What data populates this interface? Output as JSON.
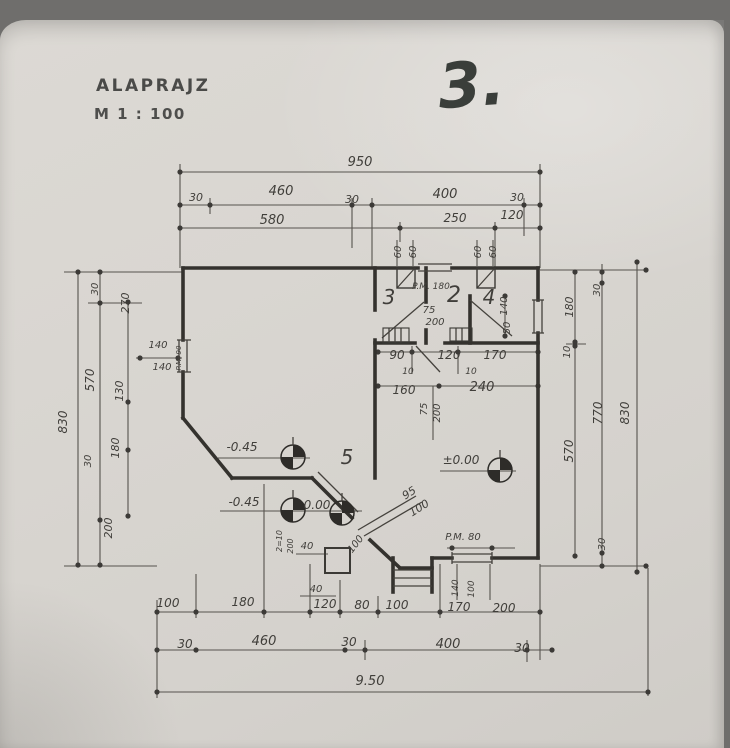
{
  "header": {
    "title": "ALAPRAJZ",
    "scale": "M 1 : 100",
    "page_number": "3."
  },
  "plan": {
    "type": "architectural floor plan",
    "rooms": [
      "1",
      "2",
      "3",
      "4",
      "5"
    ],
    "levels": [
      "-0.45",
      "0.00",
      "±0.00"
    ],
    "overall_width": "950",
    "overall_width_meters": "9.50",
    "overall_height_left": "830",
    "overall_height_right": "830",
    "labels": [
      {
        "t": "950",
        "x": 360,
        "y": 166,
        "s": 13,
        "n": "dim-overall-top"
      },
      {
        "t": "30",
        "x": 196,
        "y": 201,
        "s": 11
      },
      {
        "t": "460",
        "x": 281,
        "y": 195,
        "s": 13
      },
      {
        "t": "30",
        "x": 352,
        "y": 203,
        "s": 11
      },
      {
        "t": "400",
        "x": 445,
        "y": 198,
        "s": 13
      },
      {
        "t": "30",
        "x": 517,
        "y": 201,
        "s": 11
      },
      {
        "t": "580",
        "x": 272,
        "y": 224,
        "s": 13
      },
      {
        "t": "250",
        "x": 455,
        "y": 222,
        "s": 12
      },
      {
        "t": "120",
        "x": 512,
        "y": 219,
        "s": 12
      },
      {
        "t": "60",
        "x": 401,
        "y": 252,
        "r": -90,
        "s": 10
      },
      {
        "t": "60",
        "x": 416,
        "y": 252,
        "r": -90,
        "s": 10
      },
      {
        "t": "60",
        "x": 481,
        "y": 252,
        "r": -90,
        "s": 10
      },
      {
        "t": "60",
        "x": 496,
        "y": 252,
        "r": -90,
        "s": 10
      },
      {
        "t": "P.M. 180",
        "x": 431,
        "y": 289,
        "s": 9,
        "n": "parapet-note"
      },
      {
        "t": "3",
        "x": 389,
        "y": 304,
        "s": 20,
        "n": "room-3-label"
      },
      {
        "t": "2",
        "x": 454,
        "y": 302,
        "s": 22,
        "n": "room-2-label"
      },
      {
        "t": "4",
        "x": 489,
        "y": 304,
        "s": 20,
        "n": "room-4-label"
      },
      {
        "t": "75",
        "x": 429,
        "y": 313,
        "s": 10,
        "n": "door-size"
      },
      {
        "t": "200",
        "x": 435,
        "y": 325,
        "s": 10,
        "n": "door-size"
      },
      {
        "t": "140",
        "x": 507,
        "y": 306,
        "r": -90,
        "s": 10
      },
      {
        "t": "50",
        "x": 510,
        "y": 328,
        "r": -90,
        "s": 10
      },
      {
        "t": "90",
        "x": 397,
        "y": 359,
        "s": 12
      },
      {
        "t": "120",
        "x": 449,
        "y": 359,
        "s": 12
      },
      {
        "t": "170",
        "x": 495,
        "y": 359,
        "s": 12
      },
      {
        "t": "10",
        "x": 408,
        "y": 374,
        "s": 9
      },
      {
        "t": "10",
        "x": 471,
        "y": 374,
        "s": 9
      },
      {
        "t": "160",
        "x": 404,
        "y": 394,
        "s": 12
      },
      {
        "t": "240",
        "x": 482,
        "y": 391,
        "s": 13
      },
      {
        "t": "75",
        "x": 427,
        "y": 409,
        "r": -90,
        "s": 10,
        "n": "door-size"
      },
      {
        "t": "200",
        "x": 440,
        "y": 413,
        "r": -90,
        "s": 10,
        "n": "door-size"
      },
      {
        "t": "140",
        "x": 158,
        "y": 348,
        "s": 10,
        "n": "window-size"
      },
      {
        "t": "140",
        "x": 162,
        "y": 370,
        "s": 10,
        "n": "window-size"
      },
      {
        "t": "P.M. 90",
        "x": 181,
        "y": 358,
        "r": -90,
        "s": 7,
        "n": "parapet-note"
      },
      {
        "t": "-0.45",
        "x": 242,
        "y": 451,
        "s": 12,
        "n": "level-mark-text"
      },
      {
        "t": "5",
        "x": 347,
        "y": 464,
        "s": 20,
        "n": "room-5-label"
      },
      {
        "t": "±0.00",
        "x": 461,
        "y": 464,
        "s": 12,
        "n": "level-mark-text"
      },
      {
        "t": "-0.45",
        "x": 244,
        "y": 506,
        "s": 12,
        "n": "level-mark-text"
      },
      {
        "t": "0.00",
        "x": 317,
        "y": 509,
        "s": 12,
        "n": "level-mark-text"
      },
      {
        "t": "95",
        "x": 411,
        "y": 496,
        "r": -32,
        "s": 11,
        "n": "door-size"
      },
      {
        "t": "100",
        "x": 421,
        "y": 511,
        "r": -32,
        "s": 11,
        "n": "door-size"
      },
      {
        "t": "2=10",
        "x": 282,
        "y": 541,
        "r": -90,
        "s": 8
      },
      {
        "t": "200",
        "x": 293,
        "y": 546,
        "r": -90,
        "s": 8
      },
      {
        "t": "40",
        "x": 307,
        "y": 549,
        "s": 10
      },
      {
        "t": "100",
        "x": 358,
        "y": 546,
        "r": -52,
        "s": 10
      },
      {
        "t": "40",
        "x": 316,
        "y": 592,
        "s": 10
      },
      {
        "t": "P.M. 80",
        "x": 463,
        "y": 540,
        "s": 10,
        "n": "parapet-note"
      },
      {
        "t": "140",
        "x": 458,
        "y": 588,
        "r": -90,
        "s": 9
      },
      {
        "t": "100",
        "x": 474,
        "y": 589,
        "r": -90,
        "s": 9
      },
      {
        "t": "100",
        "x": 168,
        "y": 607,
        "s": 12
      },
      {
        "t": "180",
        "x": 243,
        "y": 606,
        "s": 12
      },
      {
        "t": "120",
        "x": 325,
        "y": 608,
        "s": 12
      },
      {
        "t": "80",
        "x": 362,
        "y": 609,
        "s": 12
      },
      {
        "t": "100",
        "x": 397,
        "y": 609,
        "s": 12
      },
      {
        "t": "170",
        "x": 459,
        "y": 611,
        "s": 12
      },
      {
        "t": "200",
        "x": 504,
        "y": 612,
        "s": 12
      },
      {
        "t": "30",
        "x": 185,
        "y": 648,
        "s": 12
      },
      {
        "t": "460",
        "x": 264,
        "y": 645,
        "s": 13
      },
      {
        "t": "30",
        "x": 349,
        "y": 646,
        "s": 12
      },
      {
        "t": "400",
        "x": 448,
        "y": 648,
        "s": 13
      },
      {
        "t": "30",
        "x": 522,
        "y": 652,
        "s": 12
      },
      {
        "t": "9.50",
        "x": 370,
        "y": 685,
        "s": 13,
        "n": "dim-overall-bottom"
      },
      {
        "t": "830",
        "x": 67,
        "y": 422,
        "r": -90,
        "s": 12,
        "n": "dim-overall-left"
      },
      {
        "t": "570",
        "x": 94,
        "y": 380,
        "r": -90,
        "s": 12
      },
      {
        "t": "30",
        "x": 98,
        "y": 289,
        "r": -90,
        "s": 10
      },
      {
        "t": "200",
        "x": 112,
        "y": 528,
        "r": -90,
        "s": 11
      },
      {
        "t": "270",
        "x": 129,
        "y": 303,
        "r": -90,
        "s": 11
      },
      {
        "t": "130",
        "x": 123,
        "y": 391,
        "r": -90,
        "s": 11
      },
      {
        "t": "180",
        "x": 119,
        "y": 448,
        "r": -90,
        "s": 11
      },
      {
        "t": "30",
        "x": 91,
        "y": 461,
        "r": -90,
        "s": 10
      },
      {
        "t": "180",
        "x": 573,
        "y": 307,
        "r": -90,
        "s": 11
      },
      {
        "t": "10",
        "x": 570,
        "y": 352,
        "r": -90,
        "s": 10
      },
      {
        "t": "570",
        "x": 573,
        "y": 451,
        "r": -90,
        "s": 12
      },
      {
        "t": "30",
        "x": 600,
        "y": 290,
        "r": -90,
        "s": 10
      },
      {
        "t": "770",
        "x": 602,
        "y": 413,
        "r": -90,
        "s": 12
      },
      {
        "t": "30",
        "x": 605,
        "y": 544,
        "r": -90,
        "s": 10
      },
      {
        "t": "830",
        "x": 629,
        "y": 413,
        "r": -90,
        "s": 12,
        "n": "dim-overall-right"
      }
    ]
  }
}
